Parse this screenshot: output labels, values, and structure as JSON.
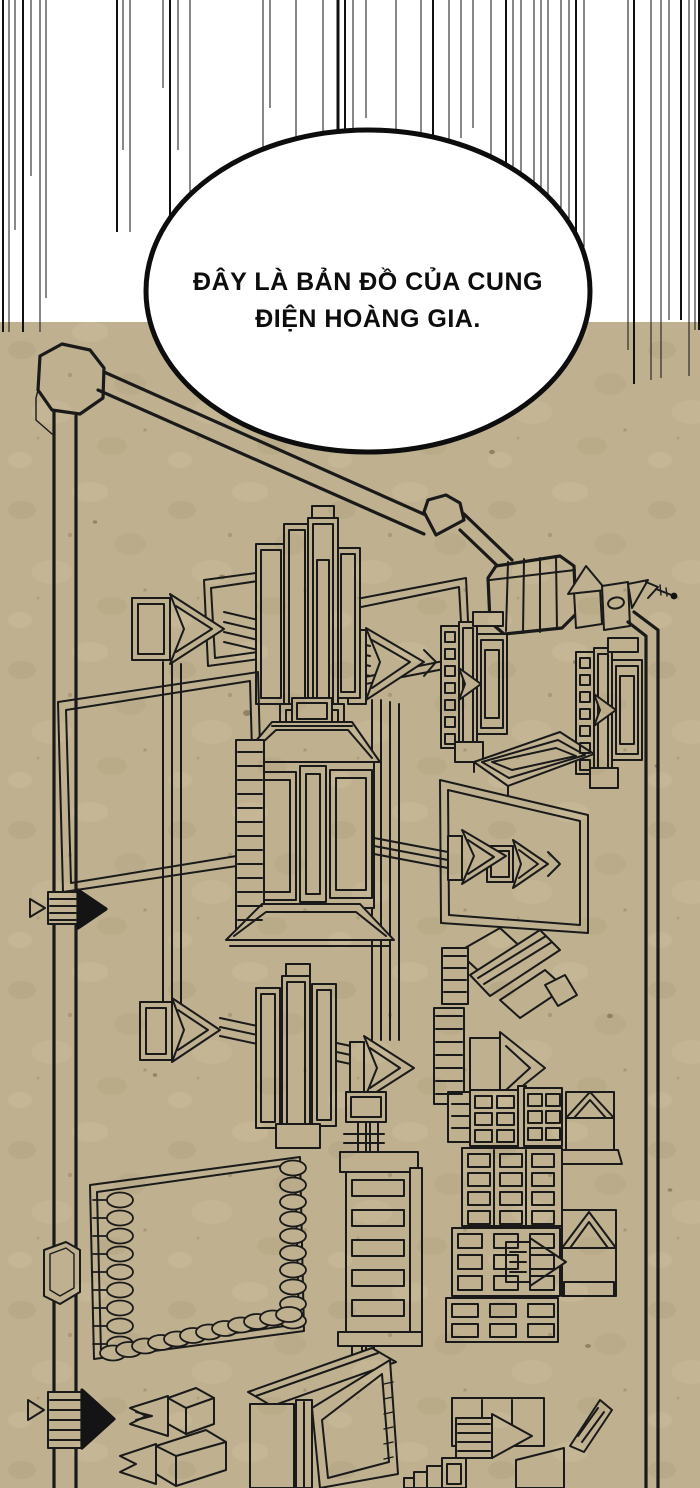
{
  "panel": {
    "speech_bubble": {
      "line1": "ĐÂY LÀ BẢN ĐỒ CỦA CUNG",
      "line2": "ĐIỆN HOÀNG GIA."
    },
    "colors": {
      "paper": "#bfb190",
      "ink": "#1a1a1a",
      "bubble_fill": "#ffffff",
      "top_background": "#ffffff"
    }
  }
}
